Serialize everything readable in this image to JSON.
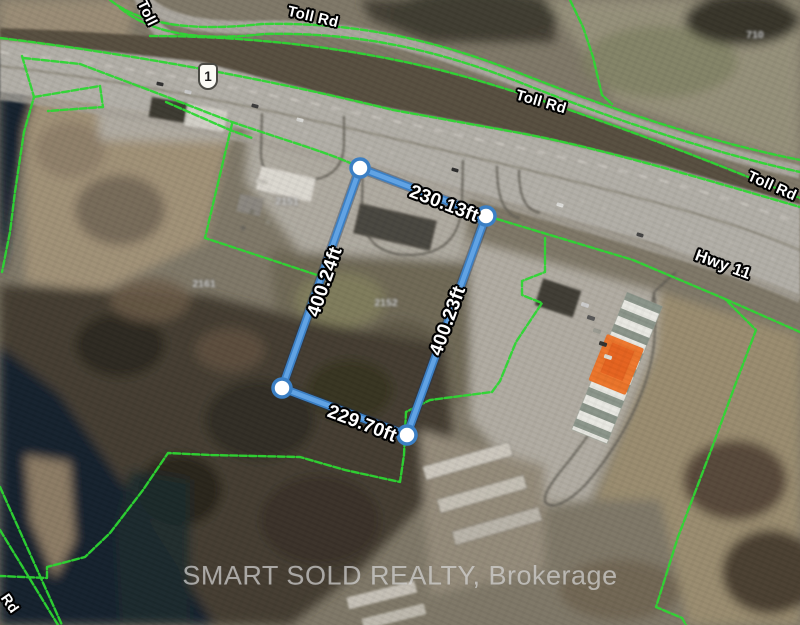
{
  "map": {
    "watermark": "SMART SOLD REALTY, Brokerage",
    "road_labels": {
      "toll_rd_top": "Toll Rd",
      "toll_rd_middle": "Toll Rd",
      "toll_rd_right": "Toll Rd",
      "toll_rd_left_vertical": "Toll",
      "hwy_11": "Hwy 11",
      "bottom_left_road": "Rd",
      "route_shield": "1"
    },
    "parcel_measurements": {
      "top_ft": "230.13ft",
      "right_ft": "400.23ft",
      "bottom_ft": "229.70ft",
      "left_ft": "400.24ft"
    },
    "blurred_address_labels": {
      "a": "2151",
      "b": "2161",
      "c": "2152",
      "d": "710"
    },
    "colors": {
      "parcel_boundary_green": "#2ed633",
      "measurement_blue": "#4f93d8",
      "highlight_building_orange": "#ee7226",
      "water_dark": "#17232d"
    }
  }
}
